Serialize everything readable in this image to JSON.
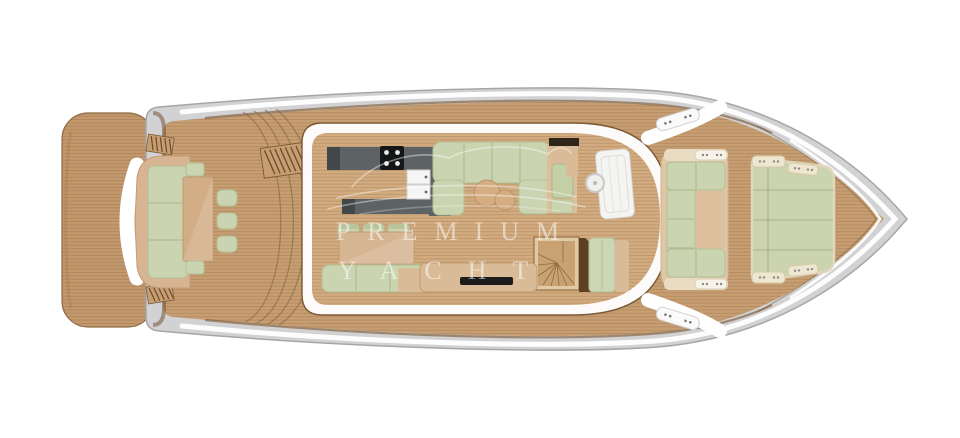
{
  "watermark": {
    "line1": "PREMIUM",
    "line2": "YACHT"
  },
  "palette": {
    "deck_wood": "#c79e72",
    "interior_wood": "#d2ab7f",
    "plank_line": "#6e4826",
    "hull_gray": "#d2d2d4",
    "hull_outline": "#a6a6a8",
    "superstructure_white": "#ffffff",
    "cushion_green": "#cbd4b0",
    "cushion_border": "#b3bf95",
    "furniture_tan": "#d6b592",
    "galley_counter": "#5d6365",
    "stove_black": "#141617",
    "accent_brown": "#6d4f33",
    "fixture_white": "#f5f5f3",
    "mat_black": "#1c1c1c",
    "sunpad_trim": "#e2d7bd"
  }
}
